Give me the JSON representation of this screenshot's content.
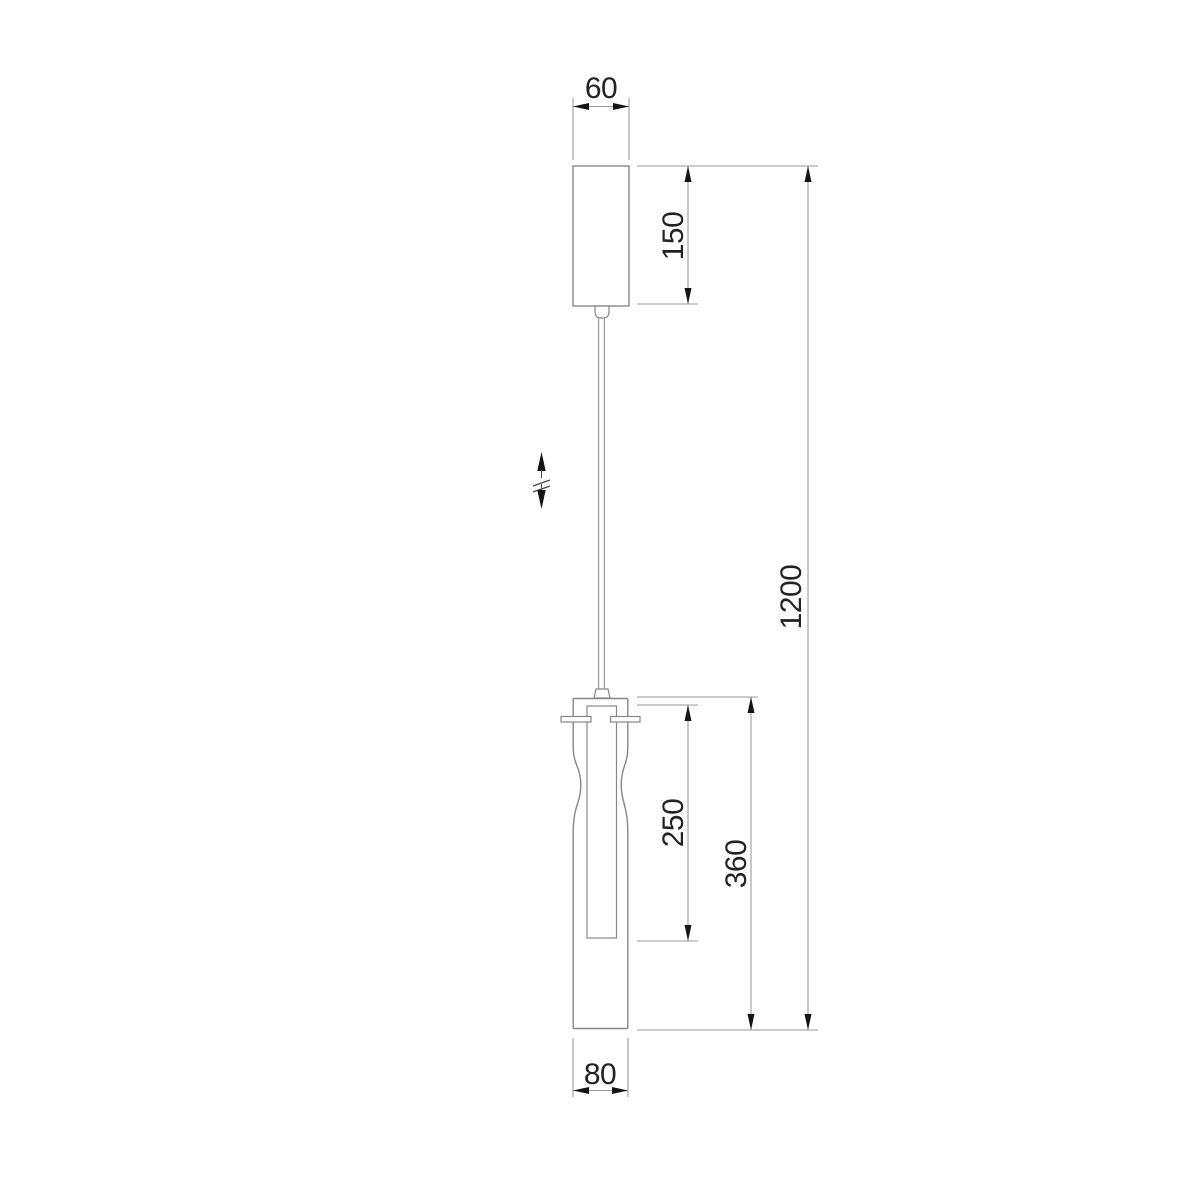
{
  "drawing": {
    "title": "Pendant lamp dimensional drawing",
    "units": "mm",
    "background": "#ffffff",
    "colors": {
      "outline": "#878787",
      "dimension_line": "#9a9a9a",
      "arrow": "#141414",
      "label": "#222222"
    },
    "labels": {
      "canopy_width": "60",
      "canopy_height": "150",
      "overall_height": "1200",
      "diffuser_height": "250",
      "body_height": "360",
      "body_width": "80"
    },
    "symbols": {
      "height_adjust": "adjustable-height-indicator"
    }
  }
}
